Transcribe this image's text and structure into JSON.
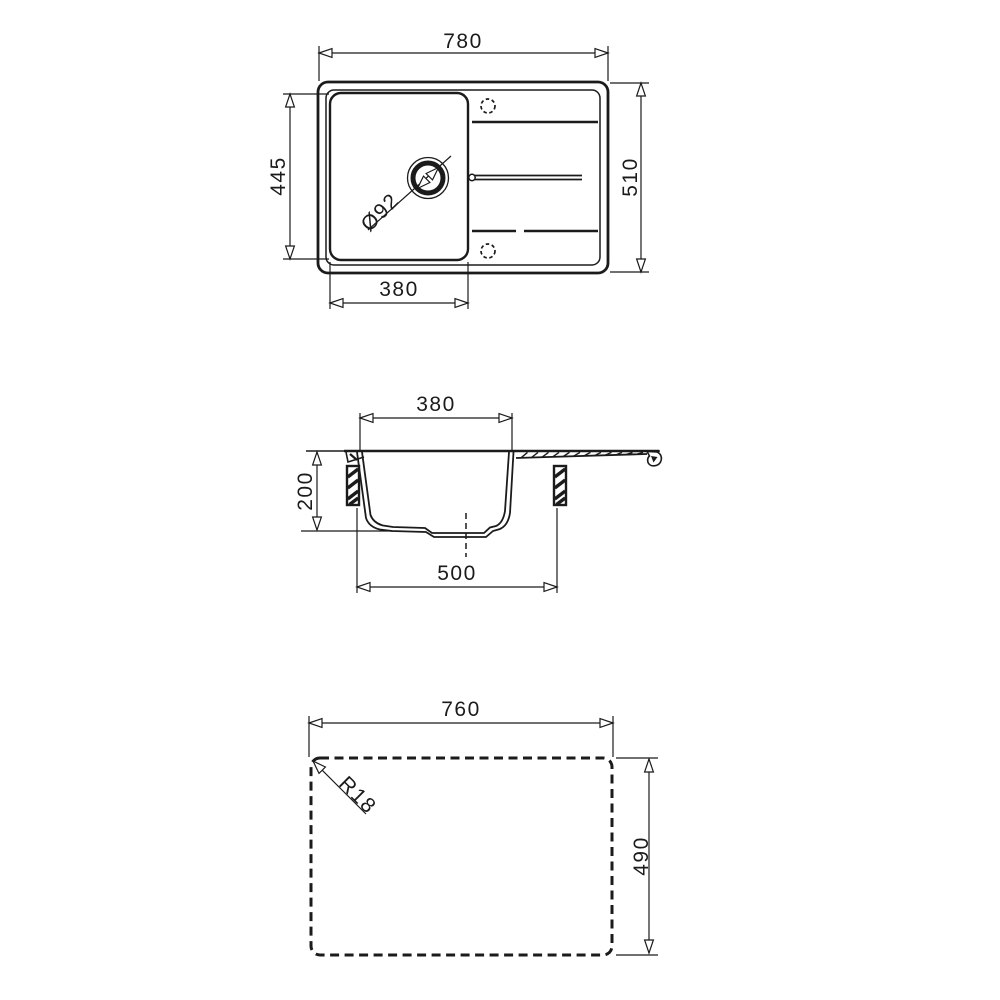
{
  "drawing": {
    "title": "sink-technical-drawing",
    "colors": {
      "line": "#1b1b1b",
      "background": "#ffffff"
    },
    "views": {
      "top": {
        "dim_overall_width": "780",
        "dim_overall_depth": "510",
        "dim_bowl_depth": "445",
        "dim_bowl_width": "380",
        "dim_drain_diameter": "Ø92"
      },
      "section": {
        "dim_bowl_width": "380",
        "dim_bowl_height": "200",
        "dim_base_width": "500"
      },
      "cutout": {
        "dim_cutout_width": "760",
        "dim_cutout_depth": "490",
        "dim_corner_radius": "R18"
      }
    }
  }
}
